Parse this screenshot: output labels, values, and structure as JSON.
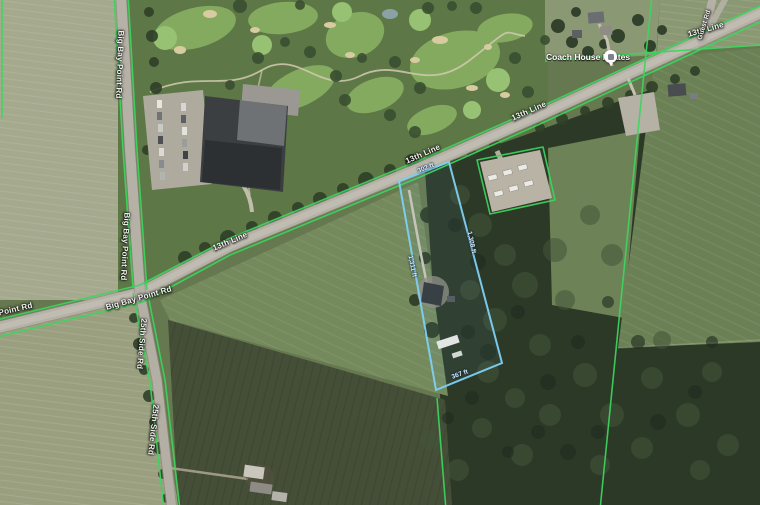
{
  "map": {
    "poi": {
      "label": "Coach House Pilates"
    },
    "roads": {
      "line13": "13th Line",
      "bigBayPoint": "Big Bay Point Rd",
      "sideRd25": "25th Side Rd",
      "branchRd": "Guest Rd"
    },
    "measurements": {
      "front": "302 ft",
      "rear": "367 ft",
      "west": "1,311 ft",
      "east": "1,308 ft"
    },
    "colors": {
      "parcel_boundary_line": "#3cd65e",
      "selected_parcel_outline": "#7fd0f5",
      "road_surface": "#b5b1a6",
      "forest": "#2c3927",
      "field_light": "#a5a98d"
    }
  }
}
